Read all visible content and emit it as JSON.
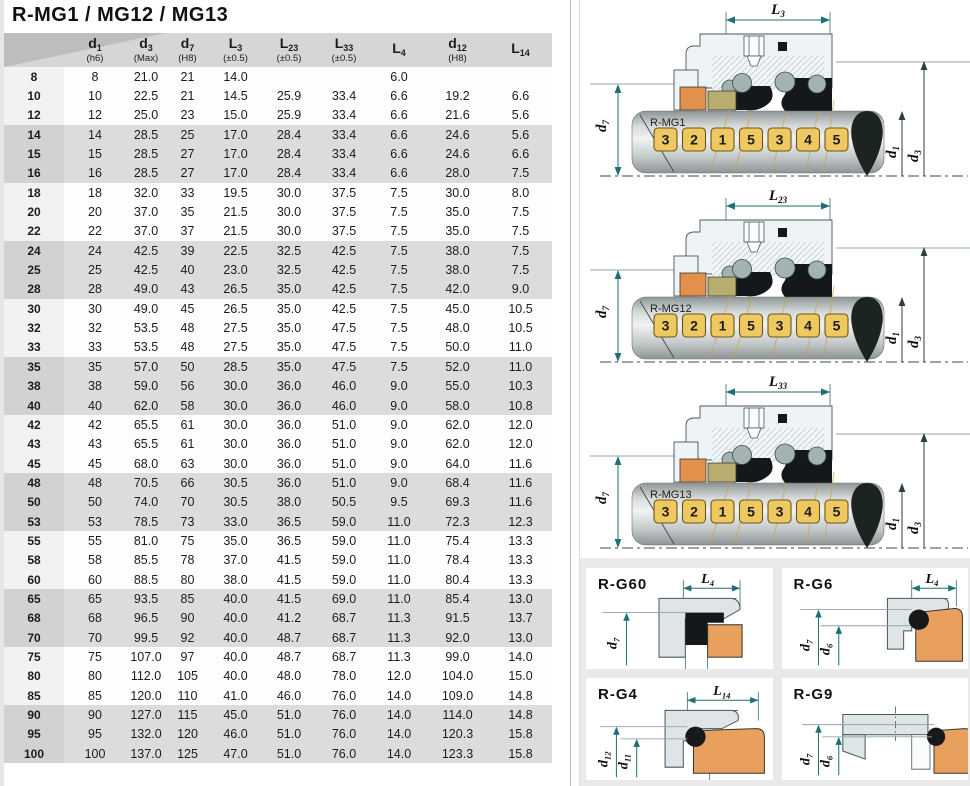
{
  "title": "R-MG1 / MG12 / MG13",
  "table": {
    "columns": [
      {
        "main": "",
        "subsc": "",
        "sub": ""
      },
      {
        "main": "d",
        "subsc": "1",
        "sub": "(h6)"
      },
      {
        "main": "d",
        "subsc": "3",
        "sub": "(Max)"
      },
      {
        "main": "d",
        "subsc": "7",
        "sub": "(H8)"
      },
      {
        "main": "L",
        "subsc": "3",
        "sub": "(±0.5)"
      },
      {
        "main": "L",
        "subsc": "23",
        "sub": "(±0.5)"
      },
      {
        "main": "L",
        "subsc": "33",
        "sub": "(±0.5)"
      },
      {
        "main": "L",
        "subsc": "4",
        "sub": ""
      },
      {
        "main": "d",
        "subsc": "12",
        "sub": "(H8)"
      },
      {
        "main": "L",
        "subsc": "14",
        "sub": ""
      }
    ],
    "rows": [
      [
        "8",
        "8",
        "21.0",
        "21",
        "14.0",
        "",
        "",
        "6.0",
        "",
        ""
      ],
      [
        "10",
        "10",
        "22.5",
        "21",
        "14.5",
        "25.9",
        "33.4",
        "6.6",
        "19.2",
        "6.6"
      ],
      [
        "12",
        "12",
        "25.0",
        "23",
        "15.0",
        "25.9",
        "33.4",
        "6.6",
        "21.6",
        "5.6"
      ],
      [
        "14",
        "14",
        "28.5",
        "25",
        "17.0",
        "28.4",
        "33.4",
        "6.6",
        "24.6",
        "5.6"
      ],
      [
        "15",
        "15",
        "28.5",
        "27",
        "17.0",
        "28.4",
        "33.4",
        "6.6",
        "24.6",
        "6.6"
      ],
      [
        "16",
        "16",
        "28.5",
        "27",
        "17.0",
        "28.4",
        "33.4",
        "6.6",
        "28.0",
        "7.5"
      ],
      [
        "18",
        "18",
        "32.0",
        "33",
        "19.5",
        "30.0",
        "37.5",
        "7.5",
        "30.0",
        "8.0"
      ],
      [
        "20",
        "20",
        "37.0",
        "35",
        "21.5",
        "30.0",
        "37.5",
        "7.5",
        "35.0",
        "7.5"
      ],
      [
        "22",
        "22",
        "37.0",
        "37",
        "21.5",
        "30.0",
        "37.5",
        "7.5",
        "35.0",
        "7.5"
      ],
      [
        "24",
        "24",
        "42.5",
        "39",
        "22.5",
        "32.5",
        "42.5",
        "7.5",
        "38.0",
        "7.5"
      ],
      [
        "25",
        "25",
        "42.5",
        "40",
        "23.0",
        "32.5",
        "42.5",
        "7.5",
        "38.0",
        "7.5"
      ],
      [
        "28",
        "28",
        "49.0",
        "43",
        "26.5",
        "35.0",
        "42.5",
        "7.5",
        "42.0",
        "9.0"
      ],
      [
        "30",
        "30",
        "49.0",
        "45",
        "26.5",
        "35.0",
        "42.5",
        "7.5",
        "45.0",
        "10.5"
      ],
      [
        "32",
        "32",
        "53.5",
        "48",
        "27.5",
        "35.0",
        "47.5",
        "7.5",
        "48.0",
        "10.5"
      ],
      [
        "33",
        "33",
        "53.5",
        "48",
        "27.5",
        "35.0",
        "47.5",
        "7.5",
        "50.0",
        "11.0"
      ],
      [
        "35",
        "35",
        "57.0",
        "50",
        "28.5",
        "35.0",
        "47.5",
        "7.5",
        "52.0",
        "11.0"
      ],
      [
        "38",
        "38",
        "59.0",
        "56",
        "30.0",
        "36.0",
        "46.0",
        "9.0",
        "55.0",
        "10.3"
      ],
      [
        "40",
        "40",
        "62.0",
        "58",
        "30.0",
        "36.0",
        "46.0",
        "9.0",
        "58.0",
        "10.8"
      ],
      [
        "42",
        "42",
        "65.5",
        "61",
        "30.0",
        "36.0",
        "51.0",
        "9.0",
        "62.0",
        "12.0"
      ],
      [
        "43",
        "43",
        "65.5",
        "61",
        "30.0",
        "36.0",
        "51.0",
        "9.0",
        "62.0",
        "12.0"
      ],
      [
        "45",
        "45",
        "68.0",
        "63",
        "30.0",
        "36.0",
        "51.0",
        "9.0",
        "64.0",
        "11.6"
      ],
      [
        "48",
        "48",
        "70.5",
        "66",
        "30.5",
        "36.0",
        "51.0",
        "9.0",
        "68.4",
        "11.6"
      ],
      [
        "50",
        "50",
        "74.0",
        "70",
        "30.5",
        "38.0",
        "50.5",
        "9.5",
        "69.3",
        "11.6"
      ],
      [
        "53",
        "53",
        "78.5",
        "73",
        "33.0",
        "36.5",
        "59.0",
        "11.0",
        "72.3",
        "12.3"
      ],
      [
        "55",
        "55",
        "81.0",
        "75",
        "35.0",
        "36.5",
        "59.0",
        "11.0",
        "75.4",
        "13.3"
      ],
      [
        "58",
        "58",
        "85.5",
        "78",
        "37.0",
        "41.5",
        "59.0",
        "11.0",
        "78.4",
        "13.3"
      ],
      [
        "60",
        "60",
        "88.5",
        "80",
        "38.0",
        "41.5",
        "59.0",
        "11.0",
        "80.4",
        "13.3"
      ],
      [
        "65",
        "65",
        "93.5",
        "85",
        "40.0",
        "41.5",
        "69.0",
        "11.0",
        "85.4",
        "13.0"
      ],
      [
        "68",
        "68",
        "96.5",
        "90",
        "40.0",
        "41.2",
        "68.7",
        "11.3",
        "91.5",
        "13.7"
      ],
      [
        "70",
        "70",
        "99.5",
        "92",
        "40.0",
        "48.7",
        "68.7",
        "11.3",
        "92.0",
        "13.0"
      ],
      [
        "75",
        "75",
        "107.0",
        "97",
        "40.0",
        "48.7",
        "68.7",
        "11.3",
        "99.0",
        "14.0"
      ],
      [
        "80",
        "80",
        "112.0",
        "105",
        "40.0",
        "48.0",
        "78.0",
        "12.0",
        "104.0",
        "15.0"
      ],
      [
        "85",
        "85",
        "120.0",
        "110",
        "41.0",
        "46.0",
        "76.0",
        "14.0",
        "109.0",
        "14.8"
      ],
      [
        "90",
        "90",
        "127.0",
        "115",
        "45.0",
        "51.0",
        "76.0",
        "14.0",
        "114.0",
        "14.8"
      ],
      [
        "95",
        "95",
        "132.0",
        "120",
        "46.0",
        "51.0",
        "76.0",
        "14.0",
        "120.3",
        "15.8"
      ],
      [
        "100",
        "100",
        "137.0",
        "125",
        "47.0",
        "51.0",
        "76.0",
        "14.0",
        "123.3",
        "15.8"
      ]
    ]
  },
  "diagrams": [
    {
      "name": "R-MG1",
      "dim": {
        "main": "L",
        "sub": "3"
      },
      "left_dim": {
        "main": "d",
        "sub": "7"
      },
      "right_dims": [
        {
          "main": "d",
          "sub": "1"
        },
        {
          "main": "d",
          "sub": "3"
        }
      ],
      "badges": [
        "3",
        "2",
        "1",
        "5",
        "3",
        "4",
        "5"
      ]
    },
    {
      "name": "R-MG12",
      "dim": {
        "main": "L",
        "sub": "23"
      },
      "left_dim": {
        "main": "d",
        "sub": "7"
      },
      "right_dims": [
        {
          "main": "d",
          "sub": "1"
        },
        {
          "main": "d",
          "sub": "3"
        }
      ],
      "badges": [
        "3",
        "2",
        "1",
        "5",
        "3",
        "4",
        "5"
      ]
    },
    {
      "name": "R-MG13",
      "dim": {
        "main": "L",
        "sub": "33"
      },
      "left_dim": {
        "main": "d",
        "sub": "7"
      },
      "right_dims": [
        {
          "main": "d",
          "sub": "1"
        },
        {
          "main": "d",
          "sub": "3"
        }
      ],
      "badges": [
        "3",
        "2",
        "1",
        "5",
        "3",
        "4",
        "5"
      ]
    }
  ],
  "panels": [
    {
      "name": "R-G60",
      "dim": {
        "main": "L",
        "sub": "4"
      },
      "v1": {
        "main": "d",
        "sub": "7"
      }
    },
    {
      "name": "R-G6",
      "dim": {
        "main": "L",
        "sub": "4"
      },
      "v1": {
        "main": "d",
        "sub": "7"
      },
      "v2": {
        "main": "d",
        "sub": "6"
      }
    },
    {
      "name": "R-G4",
      "dim": {
        "main": "L",
        "sub": "14"
      },
      "v1": {
        "main": "d",
        "sub": "12"
      },
      "v2": {
        "main": "d",
        "sub": "11"
      }
    },
    {
      "name": "R-G9",
      "v1": {
        "main": "d",
        "sub": "7"
      },
      "v2": {
        "main": "d",
        "sub": "6"
      }
    }
  ],
  "colors": {
    "dimension_teal": "#1f6f74",
    "badge_gold": "#eec961",
    "elastomer_orange": "#e2914d",
    "ptfe_khaki": "#b6ad6f",
    "rubber_black": "#15181a",
    "header_gray": "#d6d6d6",
    "band_gray": "#dcdcdc",
    "panel_bg_gray": "#e9e9e9",
    "cup_orange": "#e9a05f"
  }
}
